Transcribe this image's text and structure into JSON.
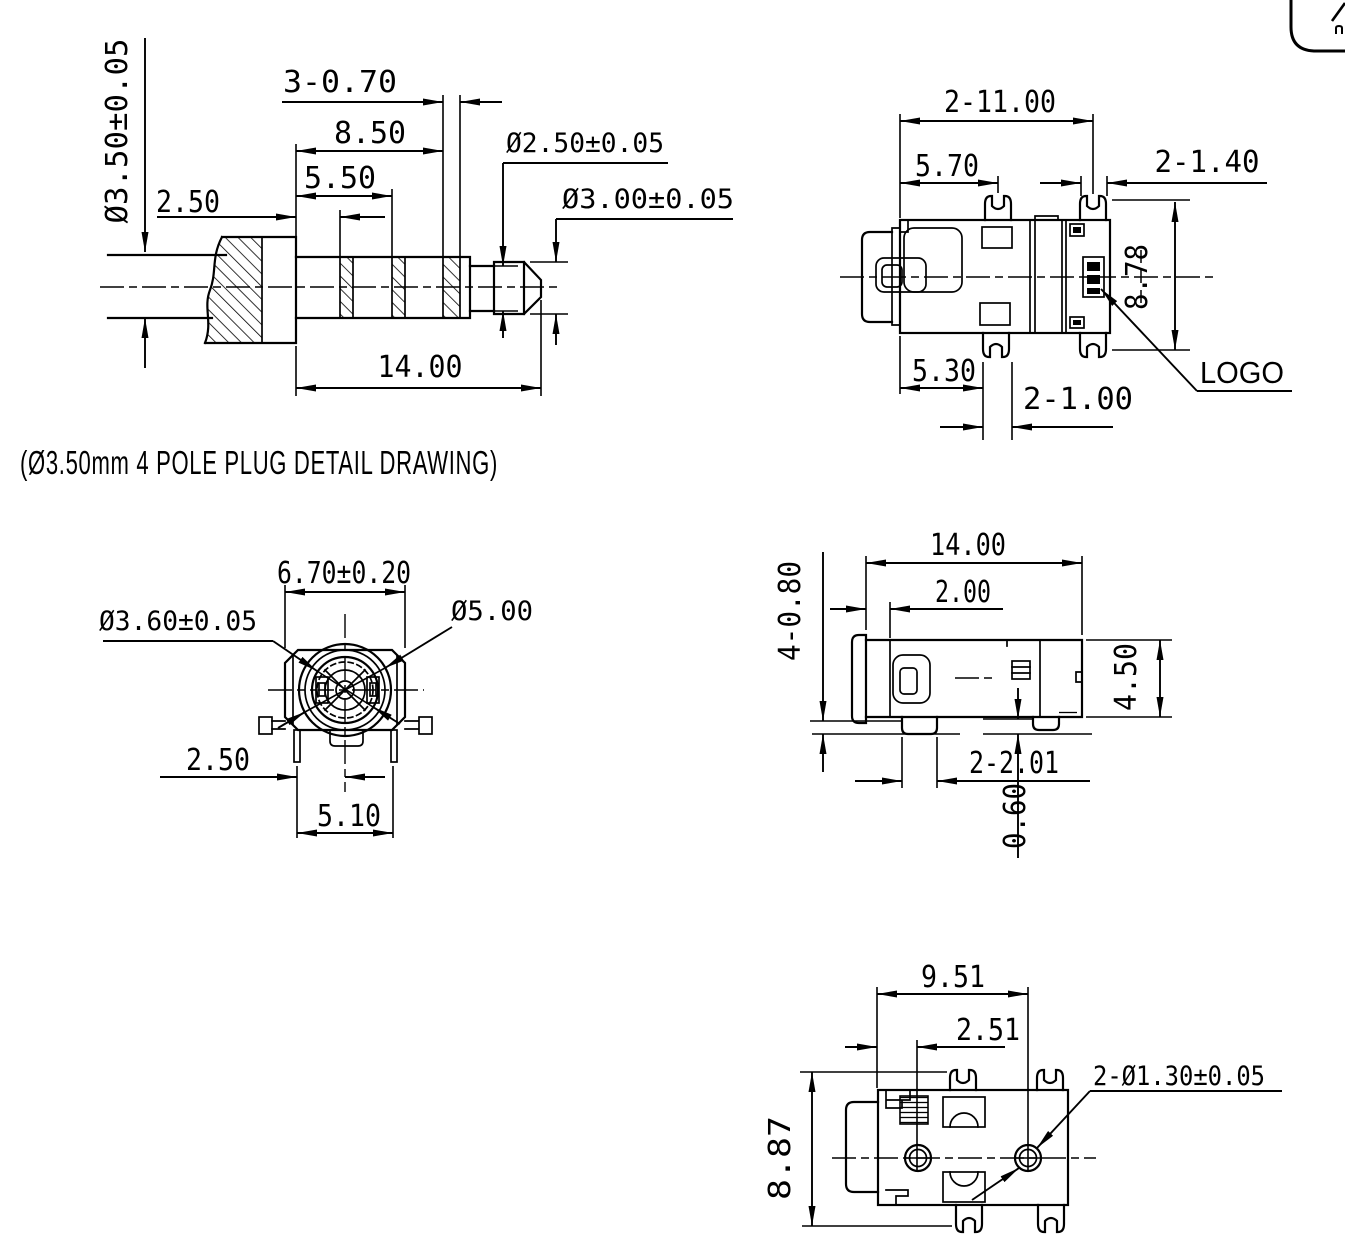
{
  "caption": "(Ø3.50mm 4 POLE PLUG DETAIL DRAWING)",
  "plug_view": {
    "ring_width": "3-0.70",
    "len_to_ring3": "8.50",
    "len_to_ring2": "5.50",
    "len_to_ring1": "2.50",
    "sleeve_dia": "Ø3.50±0.05",
    "neck_dia": "Ø2.50±0.05",
    "tip_dia": "Ø3.00±0.05",
    "plug_length": "14.00"
  },
  "top_view": {
    "fork_span": "2-11.00",
    "fork_offset_top": "5.70",
    "fork_width_top": "2-1.40",
    "body_height": "8.78",
    "fork_offset_bottom": "5.30",
    "fork_width_bottom": "2-1.00",
    "logo_label": "LOGO"
  },
  "front_view": {
    "body_width": "6.70±0.20",
    "hole_dia": "Ø3.60±0.05",
    "sleeve_dia": "Ø5.00",
    "pin_to_center": "2.50",
    "pin_span": "5.10"
  },
  "side_view": {
    "body_length": "14.00",
    "front_offset": "2.00",
    "leg_width": "4-0.80",
    "body_height": "4.50",
    "leg_pitch": "2-2.01",
    "standoff": "0.60"
  },
  "bottom_view": {
    "hole_span": "9.51",
    "hole_offset": "2.51",
    "hole_dia": "2-Ø1.30±0.05",
    "body_width": "8.87"
  }
}
